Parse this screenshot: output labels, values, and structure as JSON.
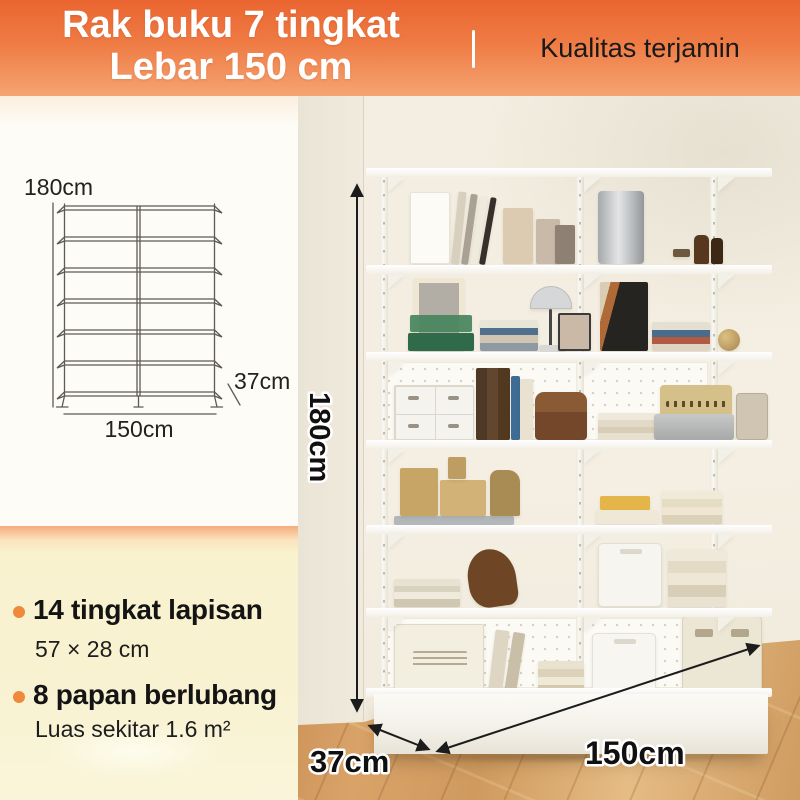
{
  "header": {
    "title_line1": "Rak buku 7 tingkat",
    "title_line2": "Lebar 150 cm",
    "tagline": "Kualitas terjamin"
  },
  "diagram": {
    "levels": 7,
    "height_label": "180cm",
    "width_label": "150cm",
    "depth_label": "37cm"
  },
  "photo_annotations": {
    "height_label": "180cm",
    "width_label": "150cm",
    "depth_label": "37cm"
  },
  "features": [
    {
      "title": "14 tingkat lapisan",
      "detail": "57 × 28 cm"
    },
    {
      "title": "8 papan berlubang",
      "detail": "Luas sekitar 1.6 m²"
    }
  ],
  "colors": {
    "header_gradient_top": "#EA6530",
    "header_gradient_bottom": "#F5A472",
    "headline_text": "#FFFFFF",
    "tagline_text": "#191919",
    "feature_panel": "#F8F2D1",
    "accent_band": "#F5AB7C",
    "bullet": "#EF8A3C",
    "wall": "#F3EEE1",
    "floor_wood": "#D7A266",
    "shelf_white": "#FBFAF6",
    "dimension_text": "#101010"
  }
}
